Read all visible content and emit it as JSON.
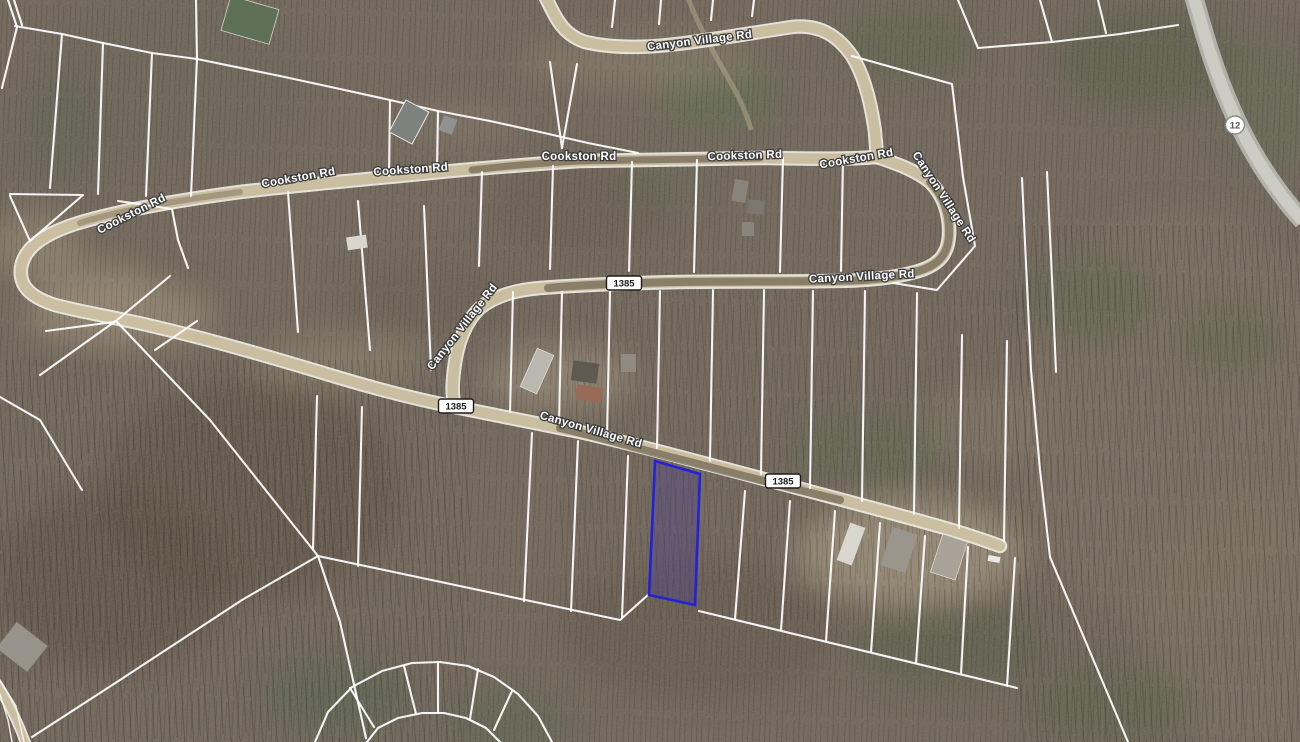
{
  "map": {
    "labels": [
      {
        "road": "canyon-village-rd",
        "text": "Canyon Village Rd"
      },
      {
        "road": "cookston-rd",
        "text": "Cookston Rd"
      },
      {
        "road": "cookston-rd",
        "text": "Cookston Rd"
      },
      {
        "road": "cookston-rd",
        "text": "Cookston Rd"
      },
      {
        "road": "cookston-rd",
        "text": "Cookston Rd"
      },
      {
        "road": "cookston-rd",
        "text": "Cookston Rd"
      },
      {
        "road": "cookston-rd",
        "text": "Cookston Rd"
      },
      {
        "road": "canyon-village-rd",
        "text": "Canyon Village Rd"
      },
      {
        "road": "canyon-village-rd",
        "text": "Canyon Village Rd"
      },
      {
        "road": "canyon-village-rd",
        "text": "Canyon Village Rd"
      },
      {
        "road": "canyon-village-rd",
        "text": "Canyon Village Rd"
      }
    ],
    "shields": [
      {
        "route": "1385",
        "text": "1385"
      },
      {
        "route": "1385",
        "text": "1385"
      },
      {
        "route": "1385",
        "text": "1385"
      },
      {
        "route": "12",
        "text": "12"
      }
    ],
    "highlighted_parcel": {
      "stroke_color": "#2222dd",
      "fill_color": "rgba(72,56,150,0.32)"
    },
    "palette": {
      "terrain": "#6f655a",
      "dirt_road": "#c9bd9e",
      "paved_road": "#c6c6c0",
      "parcel_line": "#fcfcfb",
      "shield_background": "#ffffff"
    }
  }
}
